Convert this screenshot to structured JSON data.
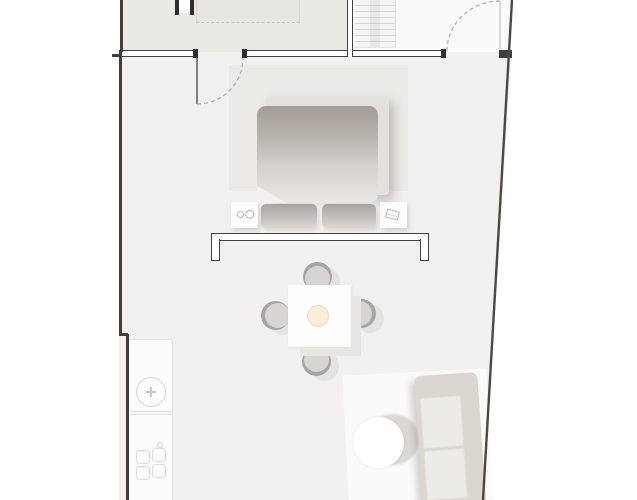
{
  "meta": {
    "kind": "architectural-floor-plan",
    "visible_text": ""
  },
  "palette": {
    "wall": "#403f3d",
    "wall_dark": "#2f2e2d",
    "floor_main": "#f2f1f0",
    "room_topleft": "#ebe9e4",
    "room_stairs": "#fafaf9",
    "cabinet": "#e7e5df",
    "rug_bed": "#ebeae7",
    "bed_frame": "#e3e1dd",
    "mattress_dark": "#a39c97",
    "mattress_light": "#eae8e5",
    "pillow_dark": "#a9a4a0",
    "pillow_light": "#dad7d4",
    "chair_seat": "#d7d4d1",
    "chair_rim": "#a8a5a0",
    "chair_shadow": "#e4e3e0",
    "bowl": "#f2e3c8",
    "counter": "#fcfcfb",
    "rug_living": "#fafaf9",
    "table_shadow": "#dcd9d5",
    "sofa_frame": "#dbd7d0",
    "sofa_cushion": "#edebe7",
    "door_arc": "#aeaca8"
  },
  "floorplan": {
    "rooms": [
      "upper-room",
      "stair-room",
      "main-studio-room"
    ],
    "doors": [
      "top-exterior-door",
      "upper-room-door-swing",
      "stair-room-door-swing"
    ],
    "furniture": [
      "staircase",
      "wardrobe-cabinet",
      "bed-rug",
      "bed-frame",
      "mattress",
      "pillow-left",
      "pillow-right",
      "nightstand-left",
      "nightstand-right",
      "glass-partition",
      "dining-table",
      "dining-chair-top",
      "dining-chair-left",
      "dining-chair-right",
      "dining-chair-bottom",
      "centerpiece-bowl",
      "kitchen-counter",
      "kitchen-sink",
      "stove-burners",
      "living-rug",
      "coffee-table",
      "sofa"
    ]
  }
}
